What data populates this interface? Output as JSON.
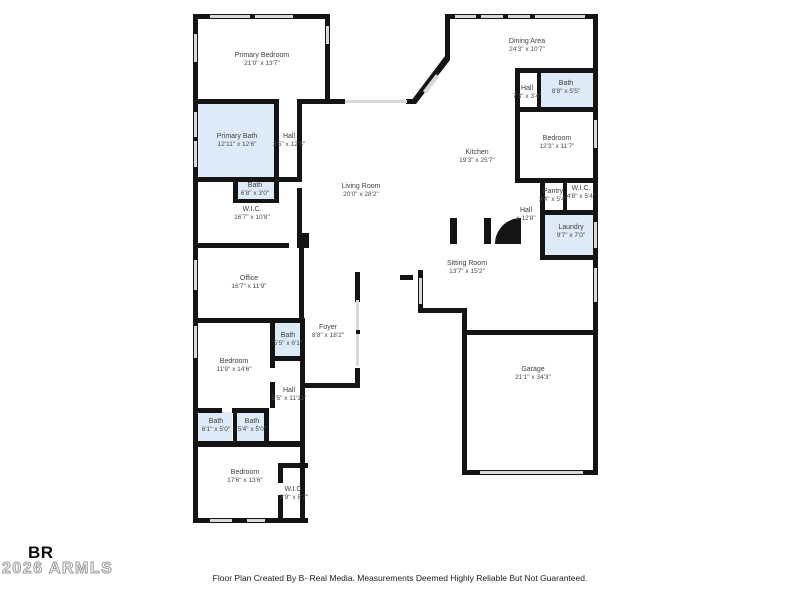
{
  "floor_plan": {
    "colors": {
      "wall": "#141414",
      "bath_fill": "#dcebf7",
      "window": "#d9d9d9",
      "label": "#3d3d3d"
    },
    "rooms": [
      {
        "id": "primary-bedroom",
        "label": "Primary Bedroom",
        "dims": "21'0\" x 13'7\""
      },
      {
        "id": "primary-bath",
        "label": "Primary Bath",
        "dims": "12'11\" x 12'6\""
      },
      {
        "id": "hall-primary",
        "label": "Hall",
        "dims": "3'5\" x 12'6\""
      },
      {
        "id": "bath-primary-small",
        "label": "Bath",
        "dims": "6'8\" x 3'0\""
      },
      {
        "id": "wic-primary",
        "label": "W.I.C.",
        "dims": "16'7\" x 10'8\""
      },
      {
        "id": "office",
        "label": "Office",
        "dims": "16'7\" x 11'9\""
      },
      {
        "id": "living-room",
        "label": "Living Room",
        "dims": "20'0\" x 28'2\""
      },
      {
        "id": "dining-area",
        "label": "Dining Area",
        "dims": "24'3\" x 10'7\""
      },
      {
        "id": "hall-upper-right",
        "label": "Hall",
        "dims": "7'3\" x 3'4\""
      },
      {
        "id": "bath-upper-right",
        "label": "Bath",
        "dims": "8'8\" x 5'5\""
      },
      {
        "id": "bedroom-right",
        "label": "Bedroom",
        "dims": "12'3\" x 11'7\""
      },
      {
        "id": "kitchen",
        "label": "Kitchen",
        "dims": "19'3\" x 25'7\""
      },
      {
        "id": "pantry",
        "label": "Pantry",
        "dims": "3'4\" x 5'4\""
      },
      {
        "id": "wic-right",
        "label": "W.I.C.",
        "dims": "4'8\" x 5'4\""
      },
      {
        "id": "hall-laundry",
        "label": "Hall",
        "dims": "x 12'8\""
      },
      {
        "id": "laundry",
        "label": "Laundry",
        "dims": "9'7\" x 7'0\""
      },
      {
        "id": "sitting-room",
        "label": "Sitting Room",
        "dims": "13'7\" x 15'2\""
      },
      {
        "id": "foyer",
        "label": "Foyer",
        "dims": "8'8\" x 18'2\""
      },
      {
        "id": "bath-mid",
        "label": "Bath",
        "dims": "5'5\" x 6'1\""
      },
      {
        "id": "bedroom-mid",
        "label": "Bedroom",
        "dims": "11'9\" x 14'6\""
      },
      {
        "id": "hall-lower",
        "label": "Hall",
        "dims": "5'5\" x 11'11\""
      },
      {
        "id": "bath-lower-left",
        "label": "Bath",
        "dims": "6'1\" x 5'0\""
      },
      {
        "id": "bath-lower-mid",
        "label": "Bath",
        "dims": "5'4\" x 5'0\""
      },
      {
        "id": "bedroom-bottom",
        "label": "Bedroom",
        "dims": "17'6\" x 13'6\""
      },
      {
        "id": "wic-bottom",
        "label": "W.I.C.",
        "dims": "3'9\" x 8'7\""
      },
      {
        "id": "garage",
        "label": "Garage",
        "dims": "21'1\" x 34'3\""
      }
    ]
  },
  "footer": {
    "disclaimer": "Floor Plan Created By B- Real Media. Measurements Deemed Highly Reliable But Not Guaranteed."
  },
  "branding": {
    "logo_text": "BR",
    "watermark": "2026 ARMLS"
  }
}
